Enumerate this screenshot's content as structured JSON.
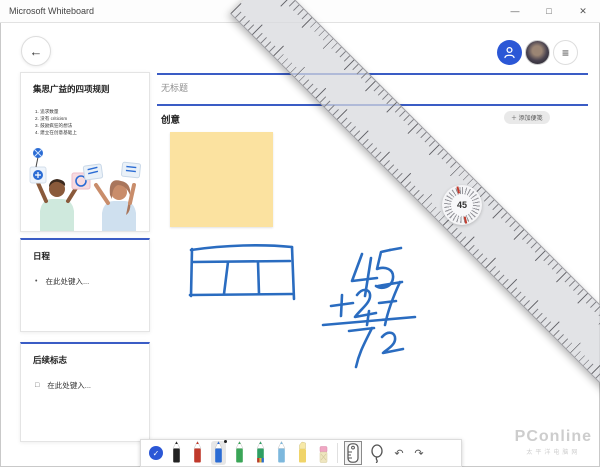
{
  "titlebar": {
    "title": "Microsoft Whiteboard",
    "minimize": "—",
    "maximize": "□",
    "close": "✕"
  },
  "topbar": {
    "back_glyph": "←",
    "menu_glyph": "≡"
  },
  "sidebar": {
    "brainstorm_card": {
      "title": "集思广益的四项规则",
      "rules": [
        "1. 追求数量",
        "2. 没有 criticism",
        "3. 鼓励疯狂的想法",
        "4. 建立在创意基础上"
      ]
    },
    "agenda_card": {
      "title": "日程",
      "bullet": "•",
      "placeholder": "在此处键入..."
    },
    "followup_card": {
      "title": "后续标志",
      "checkbox": "□",
      "placeholder": "在此处键入..."
    }
  },
  "board": {
    "title_placeholder": "无标题",
    "section_title": "创意",
    "add_note_button": "＋ 添加便笺",
    "ruler_angle": "45",
    "sticky_color": "#fbe2a0",
    "accent_color": "#3a5cc5",
    "ink_color": "#2a6cc0"
  },
  "toolbar": {
    "check_glyph": "✓",
    "undo_glyph": "↶",
    "redo_glyph": "↷",
    "tools": [
      "select-check",
      "pen-black",
      "pen-red",
      "pen-blue",
      "pen-green",
      "pen-galaxy",
      "pen-lightblue",
      "highlighter",
      "eraser",
      "ruler-tool",
      "lasso-tool",
      "undo",
      "redo"
    ],
    "selected_pen": "pen-blue",
    "selected_tool": "ruler-tool"
  },
  "watermark": {
    "line1": "PConline",
    "line2": "太平洋电脑网"
  }
}
